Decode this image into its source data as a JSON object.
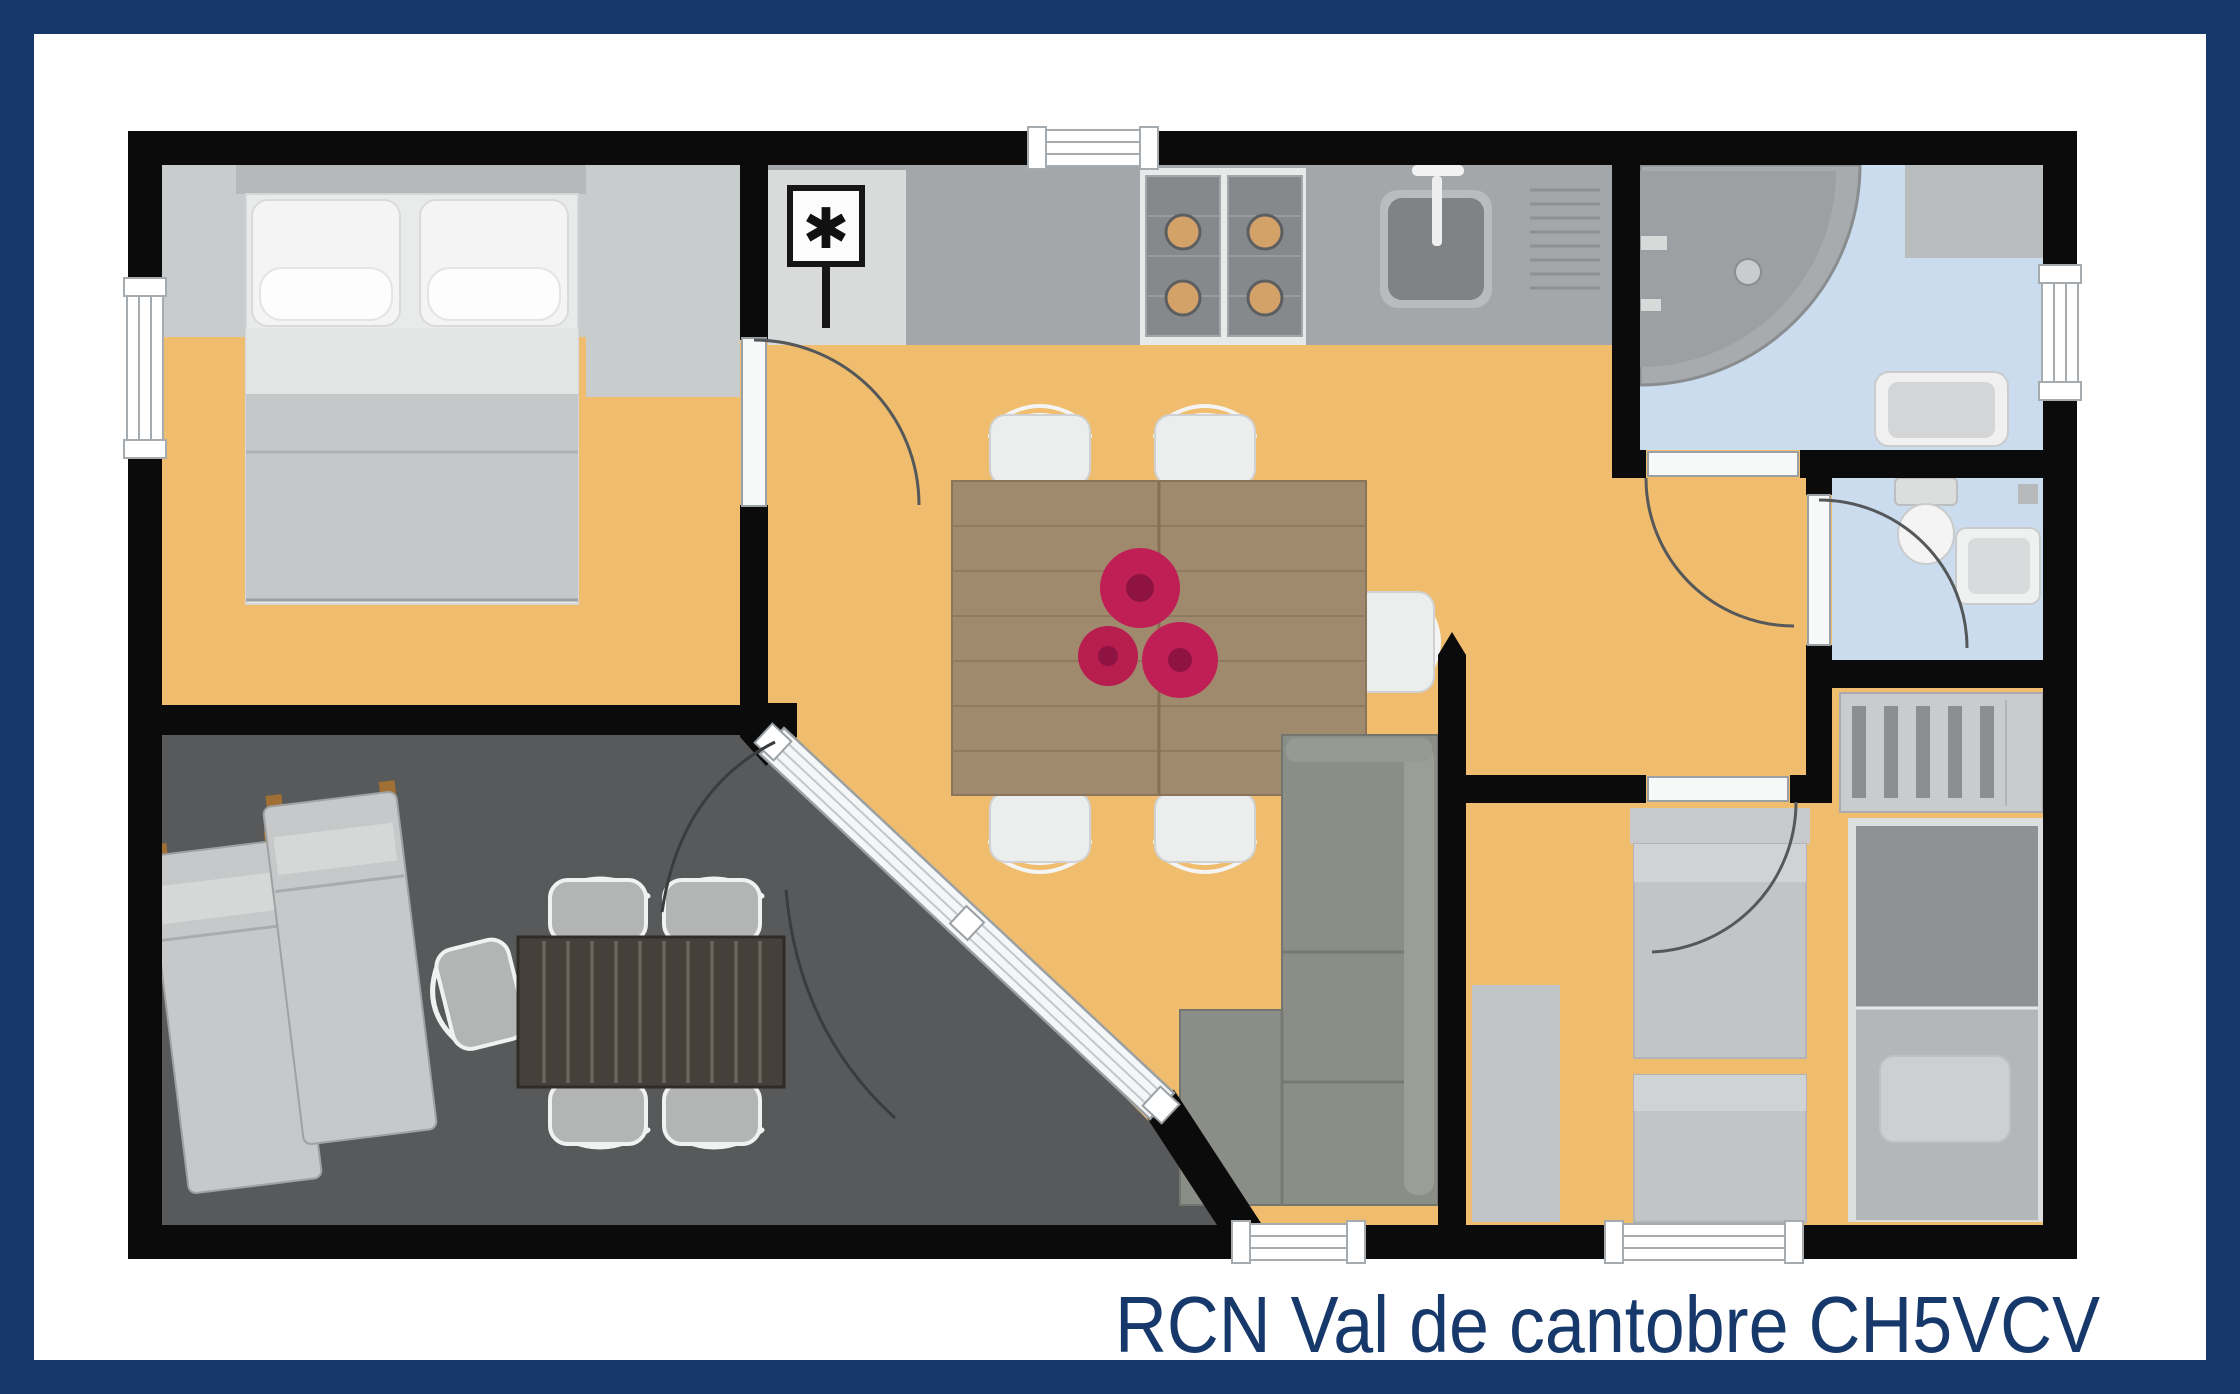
{
  "caption": {
    "text": "RCN Val de cantobre CH5VCV"
  },
  "symbols": {
    "boiler": "✱"
  },
  "palette": {
    "navy": "#17386a",
    "wall_black": "#0b0b0b",
    "floor_orange": "#f0bc6d",
    "terrace_gray": "#58595b",
    "floor_blue": "#cadcee",
    "counter_gray": "#a3a7aa",
    "boiler_panel": "#d9dbdb",
    "bedroom_gray_band": "#c9cccd",
    "table_wood": "#9f8a6e",
    "flower_magenta": "#c01f56",
    "sofa_gray": "#8b8e87",
    "furniture_light_gray": "#c6c8c9",
    "patio_table_dark": "#45413a"
  },
  "rooms": [
    {
      "name": "master-bedroom",
      "floor": "orange"
    },
    {
      "name": "kitchen-living-dining",
      "floor": "orange"
    },
    {
      "name": "bathroom",
      "floor": "blue"
    },
    {
      "name": "wc",
      "floor": "blue"
    },
    {
      "name": "second-bedroom",
      "floor": "orange"
    },
    {
      "name": "terrace",
      "floor": "dark-gray"
    }
  ],
  "furniture": [
    "double-bed",
    "boiler-unit",
    "kitchen-counter",
    "gas-stove-4-burners",
    "kitchen-sink",
    "dining-table-with-flowers",
    "five-dining-chairs",
    "corner-sofa",
    "quarter-round-shower",
    "bathroom-cabinet",
    "washbasin",
    "toilet",
    "wc-basin",
    "wardrobe",
    "bunk-bed",
    "two-single-beds",
    "bedside-mat",
    "two-sun-loungers",
    "patio-table",
    "five-patio-chairs"
  ]
}
